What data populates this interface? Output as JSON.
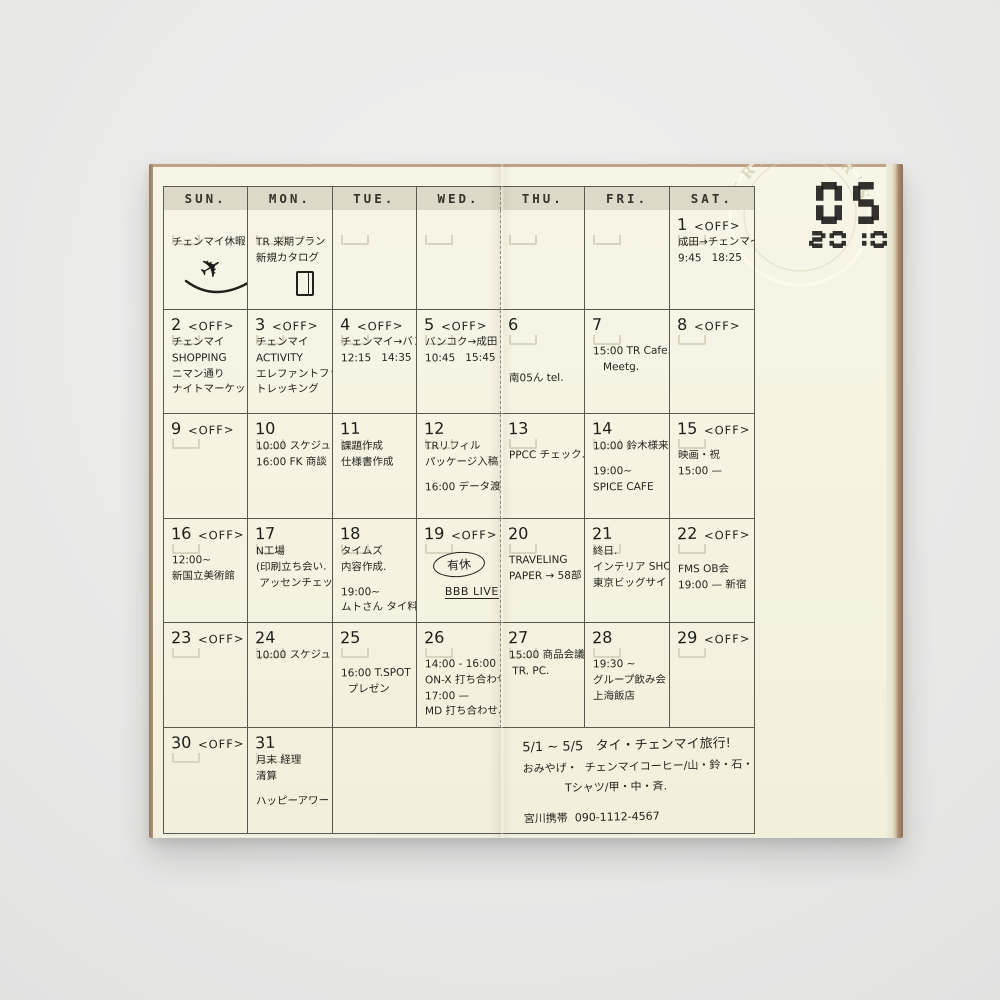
{
  "stamp": {
    "month": "05",
    "year": "2010",
    "brand": "TRAVELER'S"
  },
  "calendar": {
    "off_label": "<OFF>",
    "day_headers": [
      "SUN.",
      "MON.",
      "TUE.",
      "WED.",
      "THU.",
      "FRI.",
      "SAT."
    ],
    "weeks": [
      {
        "cells": [
          {
            "lines": [
              "チェンマイ休暇!"
            ],
            "doodle": "airplane"
          },
          {
            "lines": [
              "TR 来期プラン",
              "新規カタログ"
            ],
            "doodle": "notebook"
          },
          {},
          {},
          {},
          {},
          {
            "date": "1",
            "off": true,
            "lines": [
              "成田→チェンマイ",
              "9:45   18:25"
            ]
          }
        ]
      },
      {
        "cells": [
          {
            "date": "2",
            "off": true,
            "lines": [
              "チェンマイ",
              "SHOPPING",
              "ニマン通り",
              "ナイトマーケット"
            ]
          },
          {
            "date": "3",
            "off": true,
            "lines": [
              "チェンマイ",
              "ACTIVITY",
              "エレファントファーム",
              "トレッキング"
            ]
          },
          {
            "date": "4",
            "off": true,
            "lines": [
              "チェンマイ→バンコク",
              "12:15   14:35"
            ]
          },
          {
            "date": "5",
            "off": true,
            "lines": [
              "バンコク→成田",
              "10:45   15:45"
            ]
          },
          {
            "date": "6",
            "lines": [
              "",
              "",
              "",
              "",
              "南05ん tel."
            ]
          },
          {
            "date": "7",
            "lines": [
              "",
              "15:00 TR Cafe.",
              "   Meetg."
            ]
          },
          {
            "date": "8",
            "off": true
          }
        ]
      },
      {
        "cells": [
          {
            "date": "9",
            "off": true
          },
          {
            "date": "10",
            "lines": [
              "10:00 スケジュール㊞",
              "16:00 FK 商談"
            ]
          },
          {
            "date": "11",
            "lines": [
              "課題作成",
              "仕様書作成"
            ]
          },
          {
            "date": "12",
            "lines": [
              "TRリフィル",
              "パッケージ入稿",
              "",
              "16:00 データ渡し"
            ]
          },
          {
            "date": "13",
            "lines": [
              "",
              "PPCC チェック."
            ]
          },
          {
            "date": "14",
            "lines": [
              "10:00 鈴木様来社.",
              "",
              "19:00~",
              "SPICE CAFE"
            ]
          },
          {
            "date": "15",
            "off": true,
            "lines": [
              "",
              "映画・祝",
              "15:00 —"
            ]
          }
        ]
      },
      {
        "cells": [
          {
            "date": "16",
            "off": true,
            "lines": [
              "",
              "12:00~",
              "新国立美術館"
            ]
          },
          {
            "date": "17",
            "lines": [
              "N工場",
              "(印刷立ち会い.",
              " アッセンチェック."
            ]
          },
          {
            "date": "18",
            "lines": [
              "タイムズ",
              "内容作成.",
              "",
              "19:00~",
              "ムトさん タイ料理"
            ]
          },
          {
            "date": "19",
            "off": true,
            "lines": [
              {
                "text": "有休",
                "style": "circled"
              },
              {
                "text": "BBB LIVE",
                "style": "underlined"
              }
            ]
          },
          {
            "date": "20",
            "lines": [
              "",
              "TRAVELING",
              "PAPER → 58部"
            ]
          },
          {
            "date": "21",
            "lines": [
              "終日.",
              "インテリア SHOW",
              "東京ビッグサイト"
            ]
          },
          {
            "date": "22",
            "off": true,
            "lines": [
              "",
              "",
              "FMS OB会",
              "19:00 — 新宿"
            ]
          }
        ]
      },
      {
        "cells": [
          {
            "date": "23",
            "off": true
          },
          {
            "date": "24",
            "lines": [
              "10:00 スケジュール㊞"
            ]
          },
          {
            "date": "25",
            "lines": [
              "",
              "",
              "16:00 T.SPOT",
              "  プレゼン"
            ]
          },
          {
            "date": "26",
            "lines": [
              "",
              "14:00 - 16:00",
              "ON-X 打ち合わせ",
              "17:00 —",
              "MD 打ち合わせ."
            ]
          },
          {
            "date": "27",
            "lines": [
              "15:00 商品会議",
              " TR. PC."
            ]
          },
          {
            "date": "28",
            "lines": [
              "",
              "19:30 ~",
              "グループ飲み会",
              "上海飯店"
            ]
          },
          {
            "date": "29",
            "off": true
          }
        ]
      },
      {
        "cells": [
          {
            "date": "30",
            "off": true
          },
          {
            "date": "31",
            "lines": [
              "月末 経理",
              "清算",
              "",
              "ハッピーアワー"
            ],
            "doodle": "minibox"
          },
          {
            "span": 5,
            "notes": true
          }
        ]
      }
    ],
    "notes": {
      "lines": [
        "5/1 ~ 5/5   タイ・チェンマイ旅行!",
        "おみやげ・  チェンマイコーヒー/山・鈴・石・宮",
        "            Tシャツ/甲・中・斉.",
        "",
        "宮川携帯  090-1112-4567"
      ]
    }
  }
}
